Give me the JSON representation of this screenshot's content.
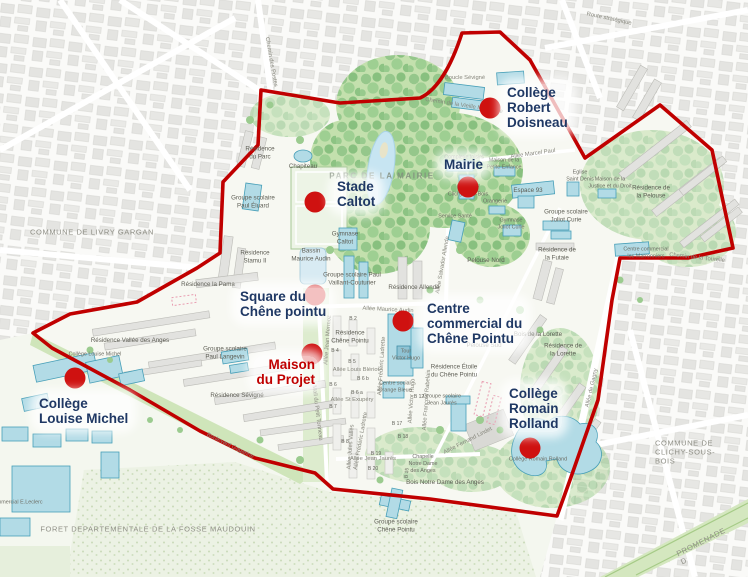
{
  "colors": {
    "boundary-color": "#c00000",
    "marker-color": "#cf1110",
    "marker-label-color": "#1f3864",
    "marker-highlight-color": "#c00000",
    "small-label-color": "#5d5d54"
  },
  "markers": [
    {
      "name": "college-robert-doisneau",
      "label": "Collège\nRobert\nDoisneau",
      "dot": {
        "x": 490,
        "y": 108
      },
      "text": {
        "x": 504,
        "y": 84,
        "align": "left"
      }
    },
    {
      "name": "mairie",
      "label": "Mairie",
      "dot": {
        "x": 468,
        "y": 187
      },
      "text": {
        "x": 441,
        "y": 156,
        "align": "left"
      }
    },
    {
      "name": "stade-caltot",
      "label": "Stade\nCaltot",
      "dot": {
        "x": 315,
        "y": 202
      },
      "text": {
        "x": 334,
        "y": 178,
        "align": "left"
      }
    },
    {
      "name": "square-du-chene-pointu",
      "label": "Square du\nChêne pointu",
      "dot": {
        "x": 315,
        "y": 295
      },
      "text": {
        "x": 237,
        "y": 288,
        "align": "left"
      }
    },
    {
      "name": "centre-commercial-du-chene-pointu",
      "label": "Centre\ncommercial du\nChêne Pointu",
      "dot": {
        "x": 403,
        "y": 321
      },
      "text": {
        "x": 424,
        "y": 300,
        "align": "left"
      }
    },
    {
      "name": "maison-du-projet",
      "label": "Maison\ndu Projet",
      "dot": {
        "x": 312,
        "y": 354
      },
      "text": {
        "x": 318,
        "y": 356,
        "align": "right"
      },
      "highlight": true
    },
    {
      "name": "college-louise-michel",
      "label": "Collège\nLouise Michel",
      "dot": {
        "x": 75,
        "y": 378
      },
      "text": {
        "x": 36,
        "y": 395,
        "align": "left"
      }
    },
    {
      "name": "college-romain-rolland",
      "label": "Collège\nRomain\nRolland",
      "dot": {
        "x": 530,
        "y": 448
      },
      "text": {
        "x": 506,
        "y": 385,
        "align": "left"
      }
    }
  ],
  "map_labels": [
    {
      "name": "commune-livry-gargan",
      "text": "COMMUNE DE LIVRY GARGAN",
      "x": 92,
      "y": 232,
      "cls": "region"
    },
    {
      "name": "commune-clichy-sous-bois",
      "text": "COMMUNE DE CLICHY-SOUS-BOIS",
      "x": 686,
      "y": 452,
      "cls": "region"
    },
    {
      "name": "foret-fosse-maudouin",
      "text": "FORET DEPARTEMENTALE DE LA FOSSE MAUDOUIN",
      "x": 148,
      "y": 529,
      "cls": "region"
    },
    {
      "name": "promenade",
      "text": "PROMENADE D",
      "x": 703,
      "y": 546,
      "cls": "region",
      "rot": -27
    },
    {
      "name": "parc-de-la-mairie",
      "text": "PARC DE LA MAIRIE",
      "x": 382,
      "y": 176,
      "cls": "park"
    },
    {
      "name": "route-strategique",
      "text": "Route stratégique",
      "x": 609,
      "y": 19,
      "cls": "road",
      "rot": 12
    },
    {
      "name": "chemin-des-postes",
      "text": "Chemin des Postes",
      "x": 271,
      "y": 62,
      "cls": "road",
      "rot": 80
    },
    {
      "name": "chemin-vieille-montagne",
      "text": "Chemin de la Vieille Montagne",
      "x": 464,
      "y": 106,
      "cls": "road",
      "rot": 9
    },
    {
      "name": "chemin-de-la-tourelle",
      "text": "Chemin de la Tourelle",
      "x": 697,
      "y": 258,
      "cls": "road",
      "rot": 6
    },
    {
      "name": "boulevard-gagarine",
      "text": "Boulevard Gagarine",
      "x": 230,
      "y": 446,
      "cls": "road",
      "rot": 26
    },
    {
      "name": "allee-de-gagny",
      "text": "Allée de Gagny",
      "x": 592,
      "y": 388,
      "cls": "road",
      "rot": -77
    },
    {
      "name": "allee-salvador-allende",
      "text": "Allée Salvador Allende",
      "x": 443,
      "y": 265,
      "cls": "road",
      "rot": -80
    },
    {
      "name": "allee-marcel-paul",
      "text": "Allée Marcel Paul",
      "x": 533,
      "y": 154,
      "cls": "road",
      "rot": -8
    },
    {
      "name": "allee-maurice-audin",
      "text": "Allée Maurice Audin",
      "x": 388,
      "y": 310,
      "cls": "road",
      "rot": 3
    },
    {
      "name": "allee-jean-mermoz",
      "text": "Allée Jean Mermoz",
      "x": 328,
      "y": 340,
      "cls": "road",
      "rot": -86
    },
    {
      "name": "allee-louis-bleriot",
      "text": "Allée Louis Blériot",
      "x": 356,
      "y": 370,
      "cls": "road"
    },
    {
      "name": "allee-frederic-ladrette",
      "text": "Allée Frédéric Ladrette",
      "x": 382,
      "y": 366,
      "cls": "road",
      "rot": -86
    },
    {
      "name": "allee-frederic-ladrette-2",
      "text": "Allée Frédéric Ladrette",
      "x": 361,
      "y": 441,
      "cls": "road",
      "rot": -80
    },
    {
      "name": "allee-st-exupery",
      "text": "Allée St Exupéry",
      "x": 352,
      "y": 400,
      "cls": "road"
    },
    {
      "name": "allee-victor-hugo",
      "text": "Allée Victor Hugo",
      "x": 412,
      "y": 401,
      "cls": "road",
      "rot": -86
    },
    {
      "name": "allee-francois-rabelais",
      "text": "Allée François Rabelais",
      "x": 427,
      "y": 400,
      "cls": "road",
      "rot": -86
    },
    {
      "name": "allee-jules-valles",
      "text": "Allée Jules Vallès",
      "x": 351,
      "y": 447,
      "cls": "road",
      "rot": -86
    },
    {
      "name": "allee-jean-jaures",
      "text": "Allée Jean Jaurès",
      "x": 373,
      "y": 459,
      "cls": "road"
    },
    {
      "name": "mail-du-petit-tonneau",
      "text": "Mail du Petit Tonneau",
      "x": 317,
      "y": 413,
      "cls": "road",
      "rot": 83
    },
    {
      "name": "allee-fernand-lindet",
      "text": "Allée Fernand Lindet",
      "x": 468,
      "y": 441,
      "cls": "road",
      "rot": -27
    },
    {
      "name": "boucle-sevigne",
      "text": "Boucle Sévigné",
      "x": 465,
      "y": 78,
      "cls": "road"
    },
    {
      "name": "residence-du-parc",
      "text": "Résidence\ndu Parc",
      "x": 260,
      "y": 153,
      "cls": "place"
    },
    {
      "name": "chapiteau",
      "text": "Chapiteau",
      "x": 303,
      "y": 167,
      "cls": "place"
    },
    {
      "name": "groupe-scolaire-paul-eluard",
      "text": "Groupe scolaire\nPaul Éluard",
      "x": 253,
      "y": 202,
      "cls": "place"
    },
    {
      "name": "residence-stamu",
      "text": "Résidence\nStamu II",
      "x": 255,
      "y": 257,
      "cls": "place"
    },
    {
      "name": "residence-la-pama",
      "text": "Résidence la Pama",
      "x": 208,
      "y": 285,
      "cls": "place"
    },
    {
      "name": "bassin-maurice-audin",
      "text": "Bassin\nMaurice Audin",
      "x": 311,
      "y": 255,
      "cls": "place"
    },
    {
      "name": "gymnase-caltot",
      "text": "Gymnase\nCaltot",
      "x": 345,
      "y": 238,
      "cls": "place"
    },
    {
      "name": "groupe-scolaire-vaillant-couturier",
      "text": "Groupe scolaire Paul\nVaillant-Couturier",
      "x": 352,
      "y": 279,
      "cls": "place"
    },
    {
      "name": "residence-allende",
      "text": "Résidence Allende",
      "x": 414,
      "y": 288,
      "cls": "place"
    },
    {
      "name": "complexe-loisirs",
      "text": "Complexe loisirs",
      "x": 464,
      "y": 158,
      "cls": "tiny"
    },
    {
      "name": "maison-petite-enfance",
      "text": "Maison de la\nPetite Enfance",
      "x": 504,
      "y": 164,
      "cls": "tiny"
    },
    {
      "name": "eglise-saint-denis",
      "text": "Eglise\nSaint Denis",
      "x": 580,
      "y": 176,
      "cls": "tiny"
    },
    {
      "name": "maison-justice-droit",
      "text": "Maison de la\nJustice et du Droit",
      "x": 610,
      "y": 183,
      "cls": "tiny"
    },
    {
      "name": "espace-93",
      "text": "Espace 93",
      "x": 528,
      "y": 191,
      "cls": "place"
    },
    {
      "name": "orangerie",
      "text": "Orangerie",
      "x": 495,
      "y": 202,
      "cls": "tiny"
    },
    {
      "name": "gymnase-joliot-curie",
      "text": "Gymnase\nJoliot Curie",
      "x": 511,
      "y": 224,
      "cls": "tiny"
    },
    {
      "name": "groupe-scolaire-joliot-curie",
      "text": "Groupe scolaire\nJoliot Curie",
      "x": 566,
      "y": 216,
      "cls": "place"
    },
    {
      "name": "residence-de-la-pelouse",
      "text": "Résidence de\nla Pelouse",
      "x": 651,
      "y": 192,
      "cls": "place"
    },
    {
      "name": "residence-de-la-futaie",
      "text": "Résidence de\nla Futaie",
      "x": 557,
      "y": 254,
      "cls": "place"
    },
    {
      "name": "pelouse-nord",
      "text": "Pelouse Nord",
      "x": 486,
      "y": 261,
      "cls": "place"
    },
    {
      "name": "service-sante",
      "text": "Service Santé",
      "x": 455,
      "y": 217,
      "cls": "tiny"
    },
    {
      "name": "mairie-building",
      "text": "Mairie de\nClichy-sous-Bois",
      "x": 468,
      "y": 191,
      "cls": "tiny"
    },
    {
      "name": "centre-commercial-marronniers",
      "text": "Centre commercial\nles Marronniers",
      "x": 646,
      "y": 253,
      "cls": "tiny"
    },
    {
      "name": "residence-vallee-des-anges",
      "text": "Résidence Vallée des Anges",
      "x": 130,
      "y": 341,
      "cls": "place"
    },
    {
      "name": "groupe-scolaire-paul-langevin",
      "text": "Groupe scolaire\nPaul Langevin",
      "x": 225,
      "y": 353,
      "cls": "place"
    },
    {
      "name": "residence-sevigne",
      "text": "Résidence Sévigné",
      "x": 237,
      "y": 396,
      "cls": "place"
    },
    {
      "name": "college-louise-michel-building",
      "text": "Collège Louise Michel",
      "x": 95,
      "y": 355,
      "cls": "tiny"
    },
    {
      "name": "residence-chene-pointu",
      "text": "Résidence\nChêne Pointu",
      "x": 350,
      "y": 337,
      "cls": "place"
    },
    {
      "name": "tour-victor-hugo",
      "text": "Tour\nVictor Hugo",
      "x": 406,
      "y": 355,
      "cls": "tiny"
    },
    {
      "name": "centre-social-orange-bleue",
      "text": "Centre social\nOrange Bleue",
      "x": 395,
      "y": 387,
      "cls": "tiny"
    },
    {
      "name": "groupe-scolaire-jean-jaures",
      "text": "Groupe scolaire\nJean Jaurès",
      "x": 442,
      "y": 400,
      "cls": "tiny"
    },
    {
      "name": "residence-etoile-chene-pointu",
      "text": "Résidence Étoile\ndu Chêne Pointu",
      "x": 454,
      "y": 371,
      "cls": "place"
    },
    {
      "name": "bois-de-la-lorette",
      "text": "Bois de la Lorette",
      "x": 538,
      "y": 335,
      "cls": "place"
    },
    {
      "name": "residence-de-la-lorette",
      "text": "Résidence de\nla Lorette",
      "x": 563,
      "y": 350,
      "cls": "place"
    },
    {
      "name": "pelouse-sud",
      "text": "Pelouse Sud",
      "x": 484,
      "y": 346,
      "cls": "place"
    },
    {
      "name": "chapelle-notre-dame",
      "text": "Chapelle\nNotre Dame\ndes Anges",
      "x": 423,
      "y": 464,
      "cls": "tiny"
    },
    {
      "name": "bois-notre-dame-des-anges",
      "text": "Bois Notre Dame des Anges",
      "x": 445,
      "y": 483,
      "cls": "place"
    },
    {
      "name": "college-romain-rolland-building",
      "text": "Collège Romain Rolland",
      "x": 538,
      "y": 460,
      "cls": "tiny"
    },
    {
      "name": "groupe-scolaire-chene-pointu",
      "text": "Groupe scolaire\nChêne Pointu",
      "x": 396,
      "y": 526,
      "cls": "place"
    },
    {
      "name": "centre-commercial-leclerc",
      "text": "Centre commercial E.Leclerc",
      "x": 8,
      "y": 503,
      "cls": "tiny"
    },
    {
      "name": "bloc-b2",
      "text": "B 2",
      "x": 353,
      "y": 319,
      "cls": "bnum"
    },
    {
      "name": "bloc-b4",
      "text": "B 4",
      "x": 335,
      "y": 351,
      "cls": "bnum"
    },
    {
      "name": "bloc-b5",
      "text": "B 5",
      "x": 352,
      "y": 362,
      "cls": "bnum"
    },
    {
      "name": "bloc-b6b",
      "text": "B 6 b",
      "x": 363,
      "y": 379,
      "cls": "bnum"
    },
    {
      "name": "bloc-b6",
      "text": "B 6",
      "x": 333,
      "y": 385,
      "cls": "bnum"
    },
    {
      "name": "bloc-b6a",
      "text": "B 6 a",
      "x": 357,
      "y": 393,
      "cls": "bnum"
    },
    {
      "name": "bloc-b7",
      "text": "B 7",
      "x": 333,
      "y": 407,
      "cls": "bnum"
    },
    {
      "name": "bloc-b8",
      "text": "B 8",
      "x": 345,
      "y": 442,
      "cls": "bnum"
    },
    {
      "name": "bloc-b12",
      "text": "B 12",
      "x": 419,
      "y": 397,
      "cls": "bnum"
    },
    {
      "name": "bloc-b15",
      "text": "B 15",
      "x": 407,
      "y": 473,
      "cls": "bnum",
      "rot": -85
    },
    {
      "name": "bloc-b17",
      "text": "B 17",
      "x": 397,
      "y": 424,
      "cls": "bnum"
    },
    {
      "name": "bloc-b18",
      "text": "B 18",
      "x": 403,
      "y": 437,
      "cls": "bnum"
    },
    {
      "name": "bloc-b19",
      "text": "B 19",
      "x": 376,
      "y": 454,
      "cls": "bnum"
    },
    {
      "name": "bloc-b20",
      "text": "B 20",
      "x": 373,
      "y": 469,
      "cls": "bnum"
    }
  ]
}
